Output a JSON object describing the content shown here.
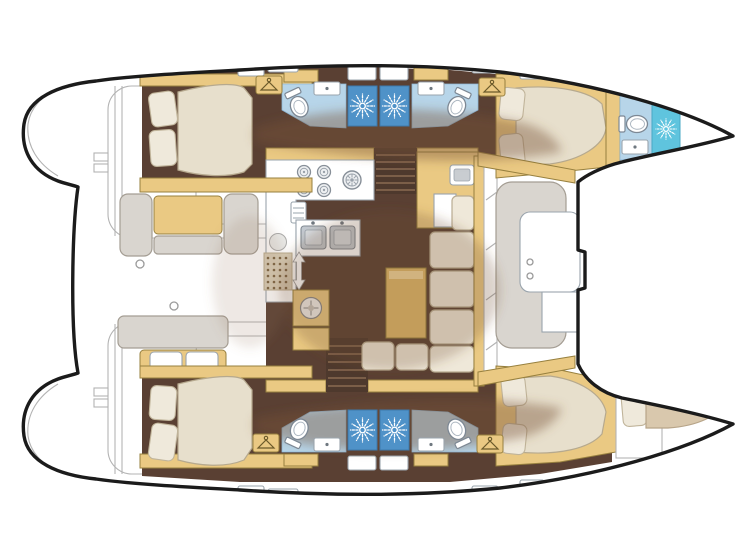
{
  "vessel": {
    "type": "catamaran",
    "view": "catamaran interior floor plan, top-down, bow to the right",
    "layout_summary": "4 double cabins, 5 heads with showers, bow crew berth, central salon with galley"
  },
  "rooms": [
    {
      "id": "port-aft-cabin",
      "label": "double cabin with island bed"
    },
    {
      "id": "port-aft-head",
      "label": "head with toilet, sink and shower"
    },
    {
      "id": "port-forward-head",
      "label": "head with toilet, sink and shower"
    },
    {
      "id": "port-forward-cabin",
      "label": "double cabin with island bed"
    },
    {
      "id": "port-bow-head",
      "label": "bow head with toilet, sink and shower"
    },
    {
      "id": "starboard-aft-cabin",
      "label": "double cabin with island bed"
    },
    {
      "id": "starboard-aft-head",
      "label": "head with toilet, sink and shower"
    },
    {
      "id": "starboard-forward-head",
      "label": "head with toilet, sink and shower"
    },
    {
      "id": "starboard-forward-cabin",
      "label": "double cabin with island bed"
    },
    {
      "id": "starboard-bow-berth",
      "label": "bow crew berth with pillow"
    },
    {
      "id": "salon",
      "label": "salon with L-shaped sofa, table and nav station"
    },
    {
      "id": "galley",
      "label": "galley with 4-burner stove, round burner, fridge and double sink"
    },
    {
      "id": "aft-cockpit",
      "label": "aft cockpit with bench seating"
    },
    {
      "id": "forward-cockpit",
      "label": "forward cockpit with C-shaped seat"
    },
    {
      "id": "trampoline",
      "label": "trampoline area between bows"
    },
    {
      "id": "swim-platforms",
      "label": "transom steps on both hulls"
    }
  ],
  "fixtures": {
    "showers": [
      {
        "x": 348,
        "y": 86,
        "w": 29,
        "h": 40,
        "variant": "blue"
      },
      {
        "x": 380,
        "y": 86,
        "w": 29,
        "h": 40,
        "variant": "blue"
      },
      {
        "x": 652,
        "y": 104,
        "w": 28,
        "h": 50,
        "variant": "cyan"
      },
      {
        "x": 348,
        "y": 410,
        "w": 29,
        "h": 40,
        "variant": "blue"
      },
      {
        "x": 380,
        "y": 410,
        "w": 29,
        "h": 40,
        "variant": "blue"
      }
    ],
    "toilets": [
      {
        "x": 298,
        "y": 104,
        "rot": -25
      },
      {
        "x": 458,
        "y": 104,
        "rot": 25
      },
      {
        "x": 634,
        "y": 124,
        "rot": -90
      },
      {
        "x": 298,
        "y": 432,
        "rot": 205
      },
      {
        "x": 458,
        "y": 432,
        "rot": 155
      }
    ],
    "sinks": [
      {
        "x": 314,
        "y": 82,
        "w": 26,
        "h": 13
      },
      {
        "x": 418,
        "y": 82,
        "w": 26,
        "h": 13
      },
      {
        "x": 622,
        "y": 140,
        "w": 26,
        "h": 14
      },
      {
        "x": 314,
        "y": 438,
        "w": 26,
        "h": 13
      },
      {
        "x": 418,
        "y": 438,
        "w": 26,
        "h": 13
      }
    ],
    "wardrobes": [
      {
        "x": 269,
        "y": 85
      },
      {
        "x": 492,
        "y": 87
      },
      {
        "x": 266,
        "y": 443
      },
      {
        "x": 490,
        "y": 444
      }
    ],
    "counts": {
      "double_beds": 4,
      "toilets": 5,
      "showers": 5,
      "sinks": 5,
      "wardrobes": 4,
      "stair_flights": 2
    }
  },
  "colors": {
    "hull-outline": "#1b1b1b",
    "deck-line": "#b3b3b3",
    "floor-brown": "#5a4033",
    "stairs-brown": "#4e392d",
    "wood-tan": "#eac983",
    "wood-tan-dark": "#e0b96a",
    "wood-border": "#97803f",
    "bed-cream": "#e7dfcc",
    "bed-border": "#b6a98e",
    "cushion-cream": "#efe8d9",
    "cushion-border": "#b9ac92",
    "bath-blue": "#b7d5e9",
    "shower-blue": "#4f92c8",
    "shower-cyan": "#5fc4de",
    "bench-gray": "#d9d5cf",
    "steel-gray": "#c3cad1",
    "overlay-brown": "rgba(118,82,58,0.42)"
  }
}
